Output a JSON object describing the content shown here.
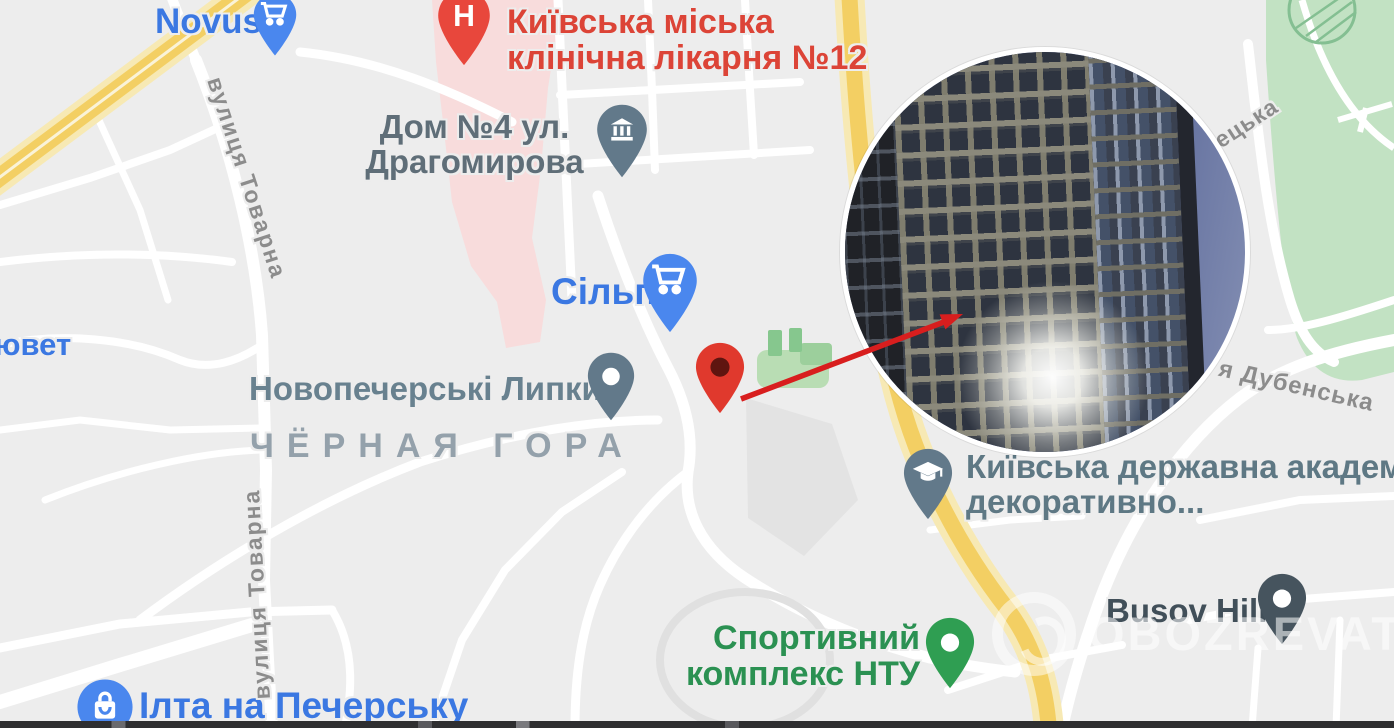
{
  "pois": {
    "novus": {
      "label": "Novus"
    },
    "hospital": {
      "line1": "Київська міська",
      "line2": "клінічна лікарня №12"
    },
    "dom": {
      "line1": "Дом №4 ул.",
      "line2": "Драгомирова"
    },
    "silpo": {
      "label": "Сільпо"
    },
    "lypky": {
      "label": "Новопечерські Липки"
    },
    "academy": {
      "line1": "Київська державна академ",
      "line2": "декоративно..."
    },
    "sport": {
      "line1": "Спортивний",
      "line2": "комплекс НТУ"
    },
    "busov": {
      "label": "Busov Hill"
    },
    "ilta": {
      "label": "Ілта на Печерську"
    },
    "iuvet": {
      "label": "ювет"
    }
  },
  "area_labels": {
    "chernaya_gora": "ЧЁРНАЯ ГОРА"
  },
  "streets": {
    "tovarna_upper": "вулиця Товарна",
    "tovarna_lower": "вулиця Товарна",
    "etska": "ецька",
    "dubenska": "я Дубенська"
  },
  "watermark": {
    "text": "OBOZREVATEL"
  },
  "colors": {
    "map_background": "#ededed",
    "road_major_yellow": "#f3cf63",
    "park_green": "#c2e2c3",
    "hospital_area_pink": "#f8dcdc",
    "poi_blue": "#3b78e2",
    "poi_red": "#dc4437",
    "poi_green": "#2b9152",
    "pin_slate": "#62798a",
    "pin_dark_slate": "#46545e",
    "marker_red": "#e0392d",
    "arrow_red": "#d81e1e"
  }
}
